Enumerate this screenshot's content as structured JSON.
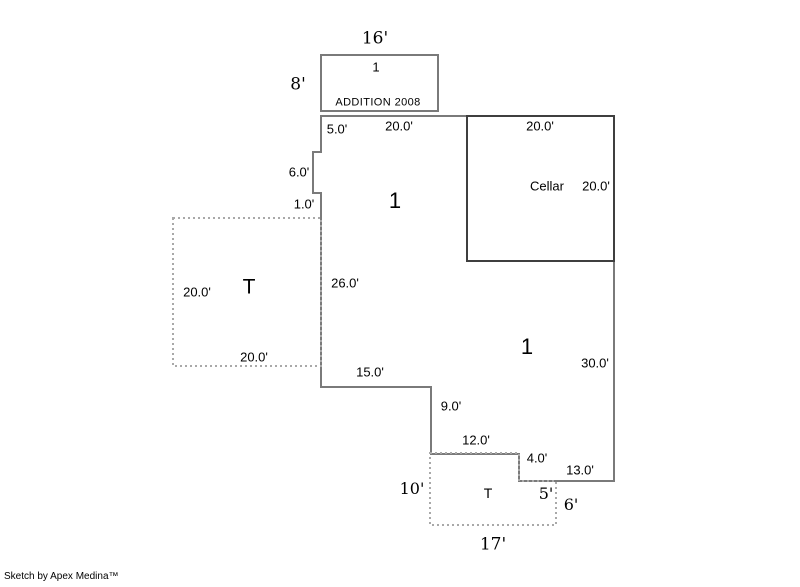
{
  "colors": {
    "wall": "#7a7a7a",
    "cellar": "#3f3f3f",
    "dashed": "#a9a9a9",
    "text": "#000000",
    "background": "#ffffff"
  },
  "addition": {
    "top_width": "16'",
    "left_height": "8'",
    "area_number": "1",
    "caption": "ADDITION 2008"
  },
  "main": {
    "area_number_upper": "1",
    "area_number_lower": "1",
    "dims": {
      "left_top": "5.0'",
      "top_west": "20.0'",
      "notch_height": "6.0'",
      "notch_jog": "1.0'",
      "left_lower": "26.0'",
      "bottom_west": "15.0'",
      "step_down_1": "9.0'",
      "step_across": "12.0'",
      "step_down_2": "4.0'",
      "bottom_east": "13.0'",
      "right_lower": "30.0'"
    }
  },
  "cellar": {
    "name": "Cellar",
    "top_width": "20.0'",
    "right_height": "20.0'"
  },
  "left_patio": {
    "label": "T",
    "left_height": "20.0'",
    "bottom_width": "20.0'"
  },
  "bottom_patio": {
    "label": "T",
    "left_height": "10'",
    "step_width": "5'",
    "right_height": "6'",
    "bottom_width": "17'"
  },
  "footer": {
    "credit": "Sketch by Apex Medina™"
  }
}
